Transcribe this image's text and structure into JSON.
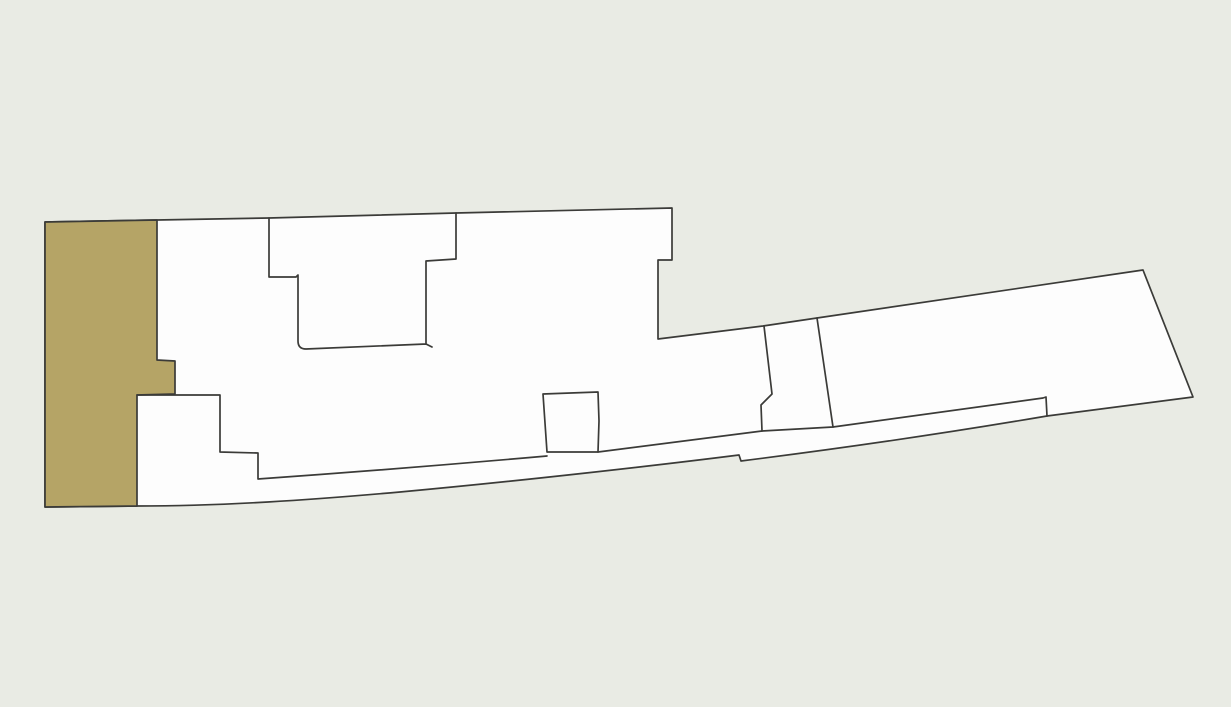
{
  "canvas": {
    "width": 1231,
    "height": 707,
    "background_color": "#e9ebe4"
  },
  "map": {
    "kind": "cadastral-parcel-map",
    "colors": {
      "background": "#e9ebe4",
      "parcel_fill": "#fdfdfd",
      "highlight_fill": "#b5a466",
      "outline": "#3b3b38"
    },
    "stroke_width": 1.7,
    "shapes": [
      {
        "name": "composite-parcel",
        "role": "outer-boundary",
        "fill": "parcel_fill",
        "interactable": true,
        "d": "M 45,222 L 157,220 L 269,218 L 456,213 L 672,208 L 672,260 L 658,260 L 658,339 L 763,326 L 817,318 L 1143,270 L 1193,397 L 1047,416 Q 900,441 741,461 L 739,455 C 660,465 520,481 400,492 C 310,500 225,506 137,506 L 45,507 Z"
      },
      {
        "name": "highlighted-parcel",
        "role": "selected-lot",
        "fill": "highlight_fill",
        "interactable": true,
        "d": "M 45,222 L 157,220 L 157,360 L 175,361 L 175,394 L 137,395 L 137,506 L 45,507 Z"
      },
      {
        "name": "tophat-lot-boundary",
        "role": "subdivision-line",
        "fill": "none",
        "interactable": false,
        "d": "M 269,218 L 269,277 L 296,277 L 298,275 L 298,341 Q 298,349 306,349 L 426,344 L 426,261 L 456,259 L 456,213 M 426,344 L 432,347"
      },
      {
        "name": "lower-left-steps-boundary",
        "role": "subdivision-line",
        "fill": "none",
        "interactable": false,
        "d": "M 137,395 L 220,395 L 220,452 L 258,453 L 258,479 Q 400,469 547,456"
      },
      {
        "name": "small-lot-boundary",
        "role": "subdivision-line",
        "fill": "none",
        "interactable": false,
        "d": "M 547,452 L 543,394 L 598,392 L 599,421 L 598,452 L 547,452 Z"
      },
      {
        "name": "road-strip-top-boundary",
        "role": "subdivision-line",
        "fill": "none",
        "interactable": false,
        "d": "M 598,452 Q 690,440 762,431 L 833,427 L 1043,398 L 1046,397 L 1047,416"
      },
      {
        "name": "connector-lot-left-boundary",
        "role": "subdivision-line",
        "fill": "none",
        "interactable": false,
        "d": "M 764,326 L 772,394 L 761,405 L 762,431"
      },
      {
        "name": "quad-lot-left-boundary",
        "role": "subdivision-line",
        "fill": "none",
        "interactable": false,
        "d": "M 817,318 L 833,427"
      }
    ]
  }
}
